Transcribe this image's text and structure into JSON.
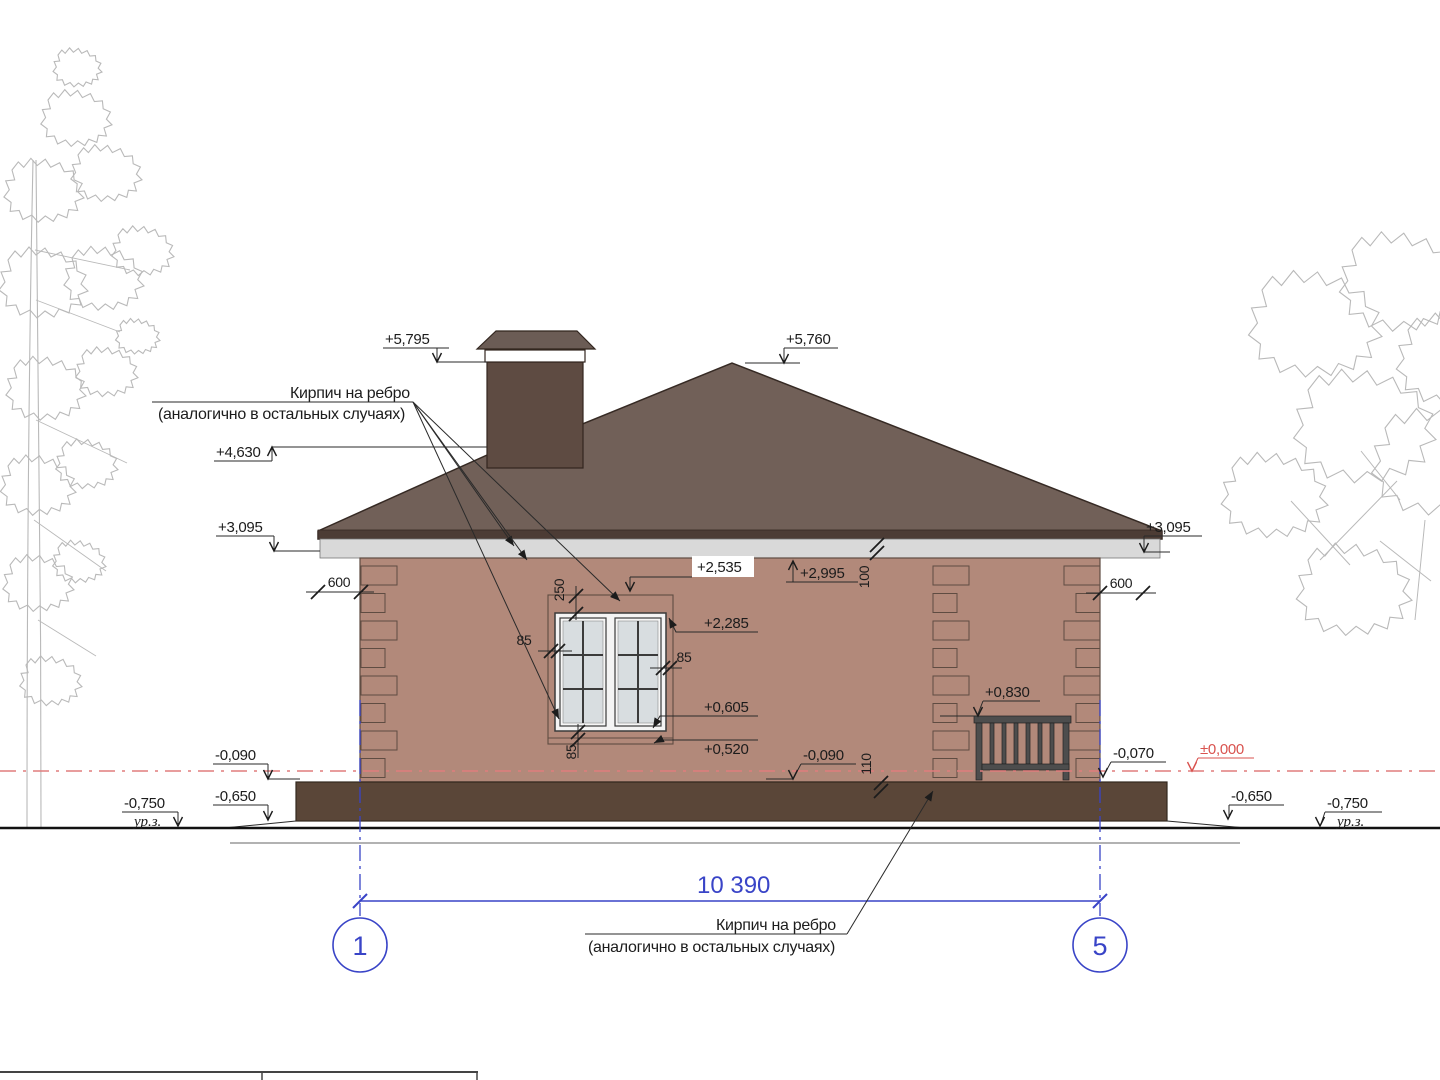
{
  "notes": {
    "brick_line1": "Кирпич на ребро",
    "brick_line2": "(аналогично в остальных случаях)"
  },
  "levels": {
    "chimney_top": "+5,795",
    "ridge": "+5,760",
    "hip_ridge": "+4,630",
    "eave_left": "+3,095",
    "eave_right": "+3,095",
    "wall_top": "+2,995",
    "window_lintel": "+2,535",
    "window_head": "+2,285",
    "porch_rail": "+0,830",
    "window_sill": "+0,605",
    "sill_course": "+0,520",
    "plinth_left": "-0,090",
    "plinth_mid": "-0,090",
    "plinth_right": "-0,070",
    "zero": "±0,000",
    "blind_area_left": "-0,650",
    "blind_area_right": "-0,650",
    "ground_left": "-0,750",
    "ground_right": "-0,750"
  },
  "dims": {
    "overall": "10 390",
    "quoin_left": "600",
    "quoin_right": "600",
    "lintel_band": "250",
    "jamb_left": "85",
    "jamb_right": "85",
    "sill_band": "85",
    "eave_band": "100",
    "plinth_band": "110"
  },
  "axes": {
    "left": "1",
    "right": "5"
  },
  "ground_label": "ур.з.",
  "colors": {
    "wall": "#b2897a",
    "roof": "#716058",
    "fascia": "#4c3c35",
    "eave_band": "#d9d9d9",
    "plinth": "#5a4638",
    "chimney": "#5e4b42",
    "chimney_cap": "#6b5c55",
    "axis_blue": "#3944c7",
    "zero_red": "#d9534f"
  }
}
